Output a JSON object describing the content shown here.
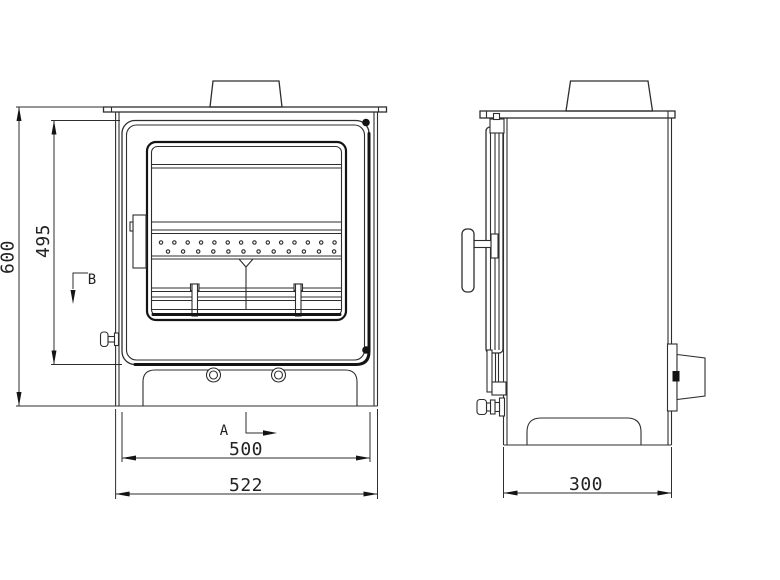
{
  "dimensions": {
    "overall_height": "600",
    "door_height": "495",
    "inner_width": "500",
    "overall_width": "522",
    "overall_depth": "300"
  },
  "datum_labels": {
    "view_a": "A",
    "view_b": "B"
  },
  "colors": {
    "background": "#ffffff",
    "line": "#2e2e2e",
    "heavy_line": "#141414",
    "text": "#222222"
  }
}
